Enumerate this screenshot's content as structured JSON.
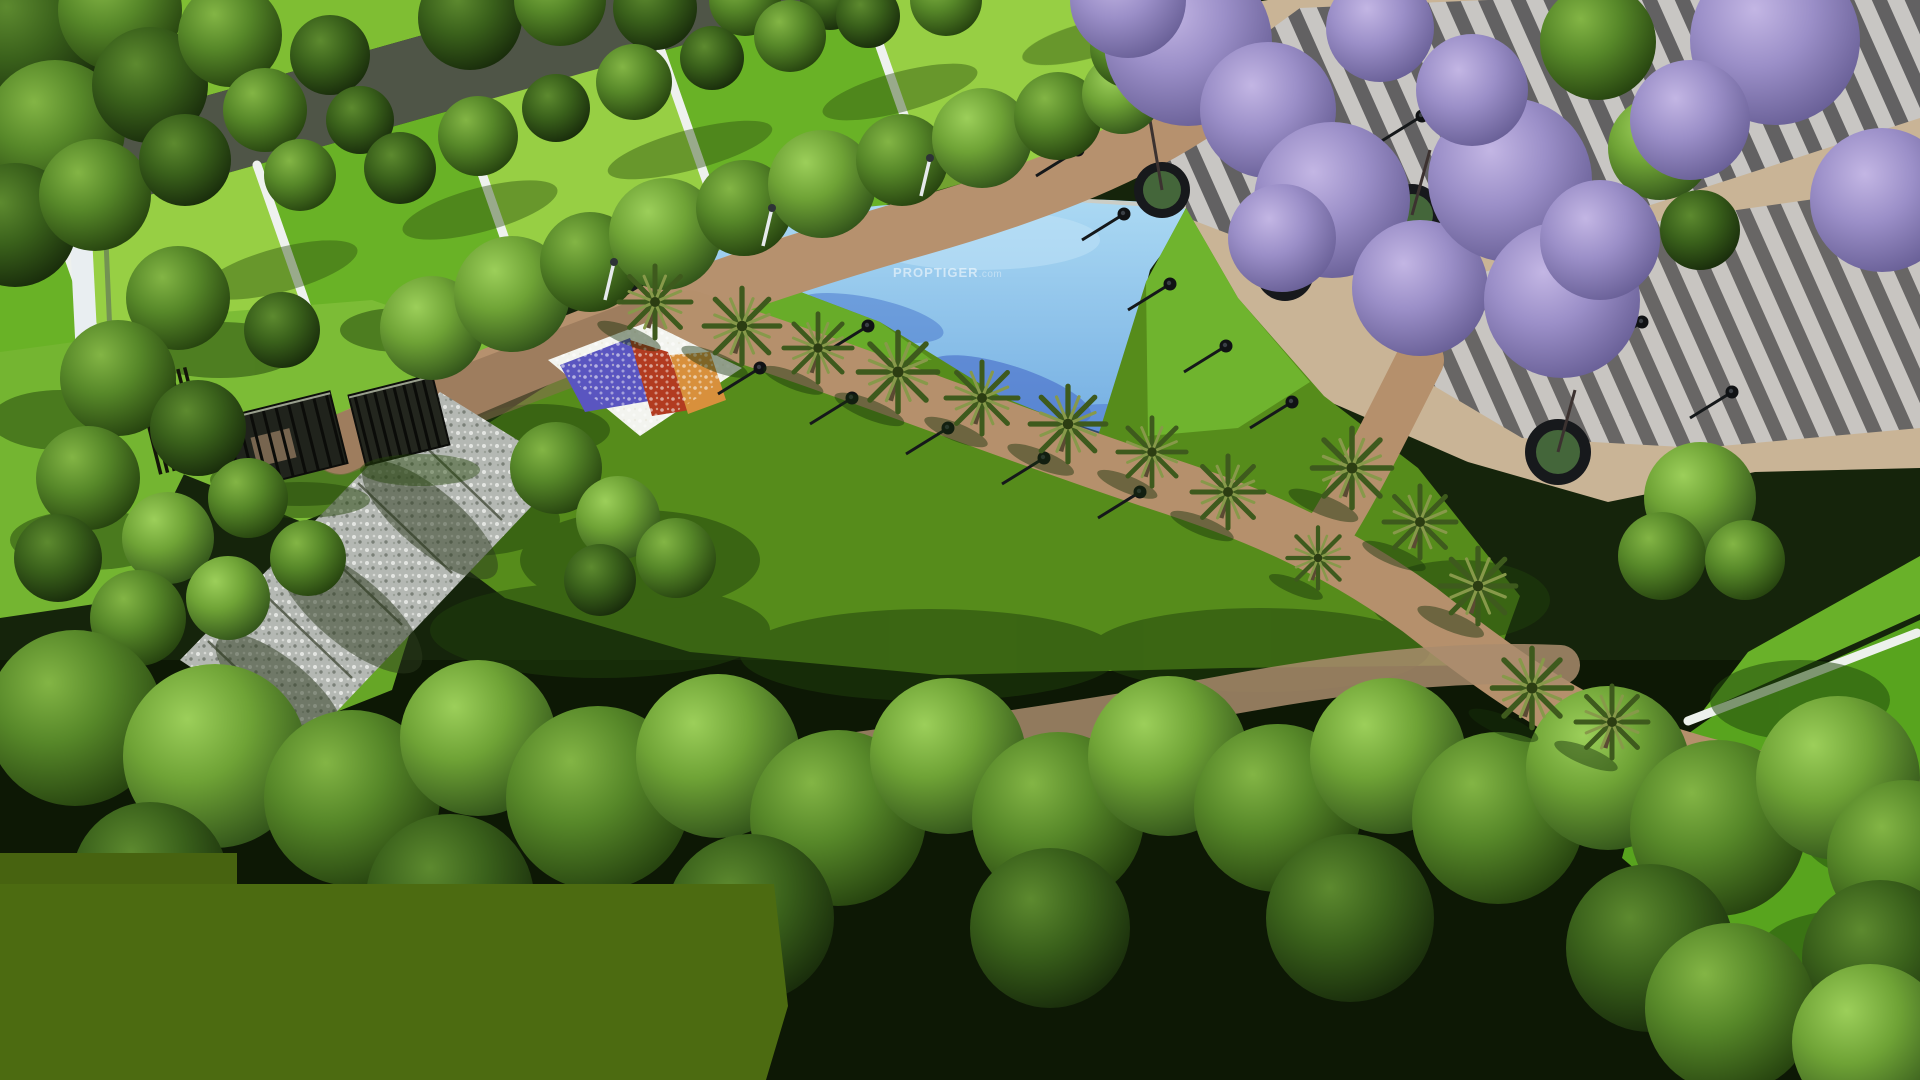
{
  "scene": {
    "type": "aerial-3d-architectural-render",
    "description": "Bird's-eye 3D render of a plotted township landscape garden: rows of lawn plots with white dividers, a tree-lined access road, central park with blue pond, palm-lined walkways, grey striped plaza with jacaranda trees in round planters, flower bed, pergola gate structures, pebble path and dense perimeter trees",
    "watermark": {
      "brand": "PROPTIGER",
      "suffix": ".com"
    },
    "palette": {
      "base_shadow": "#15240b",
      "plot_green_light": "#97cf44",
      "plot_green_dark": "#69b226",
      "divider_white": "#eef1ee",
      "road_gray": "#4f5547",
      "wall_white": "#e9eef1",
      "lawn_base": "#568c1b",
      "lawn_bright": "#6fb42e",
      "lawn_side": "#7cbc36",
      "pond_blue_light": "#abd9f3",
      "pond_blue_mid": "#74aee2",
      "pond_shadow_blue": "#4066c6",
      "paver_tan": "#b6916e",
      "plaza_tan": "#c9b496",
      "plaza_stripe_dark": "#57585c",
      "plaza_stripe_light": "#c8c8c8",
      "pebble_gray": "#b4b8b3",
      "flower_white": "#f3f4ef",
      "flower_violet": "#5a55c0",
      "flower_red": "#b23b20",
      "flower_orange": "#d8903c",
      "jacaranda_purple": "#9b8fc8",
      "palm_frond_dark": "#3e5a1d",
      "palm_frond_light": "#87994a",
      "tree_sunlit": "#8cc04a",
      "tree_mid": "#55842a",
      "tree_dark": "#274812",
      "flat_patch_olive": "#4c6b11",
      "watermark_color": "rgba(255,255,255,0.55)",
      "watermark_suffix_color": "rgba(255,255,255,0.4)"
    },
    "inventory": [
      "residential plot rows upper-left",
      "residential plot rows upper-right",
      "tree lined access road",
      "white boundary wall",
      "blue pond",
      "central lawn",
      "grey striped plaza",
      "jacaranda trees in circular planters",
      "palm lined walkway",
      "tan paver walkways",
      "pebble stone path",
      "flower bed (white, violet, red, orange)",
      "pergola gate structures",
      "garden lamp posts",
      "perimeter tree band",
      "flat olive green patch bottom-left"
    ]
  }
}
